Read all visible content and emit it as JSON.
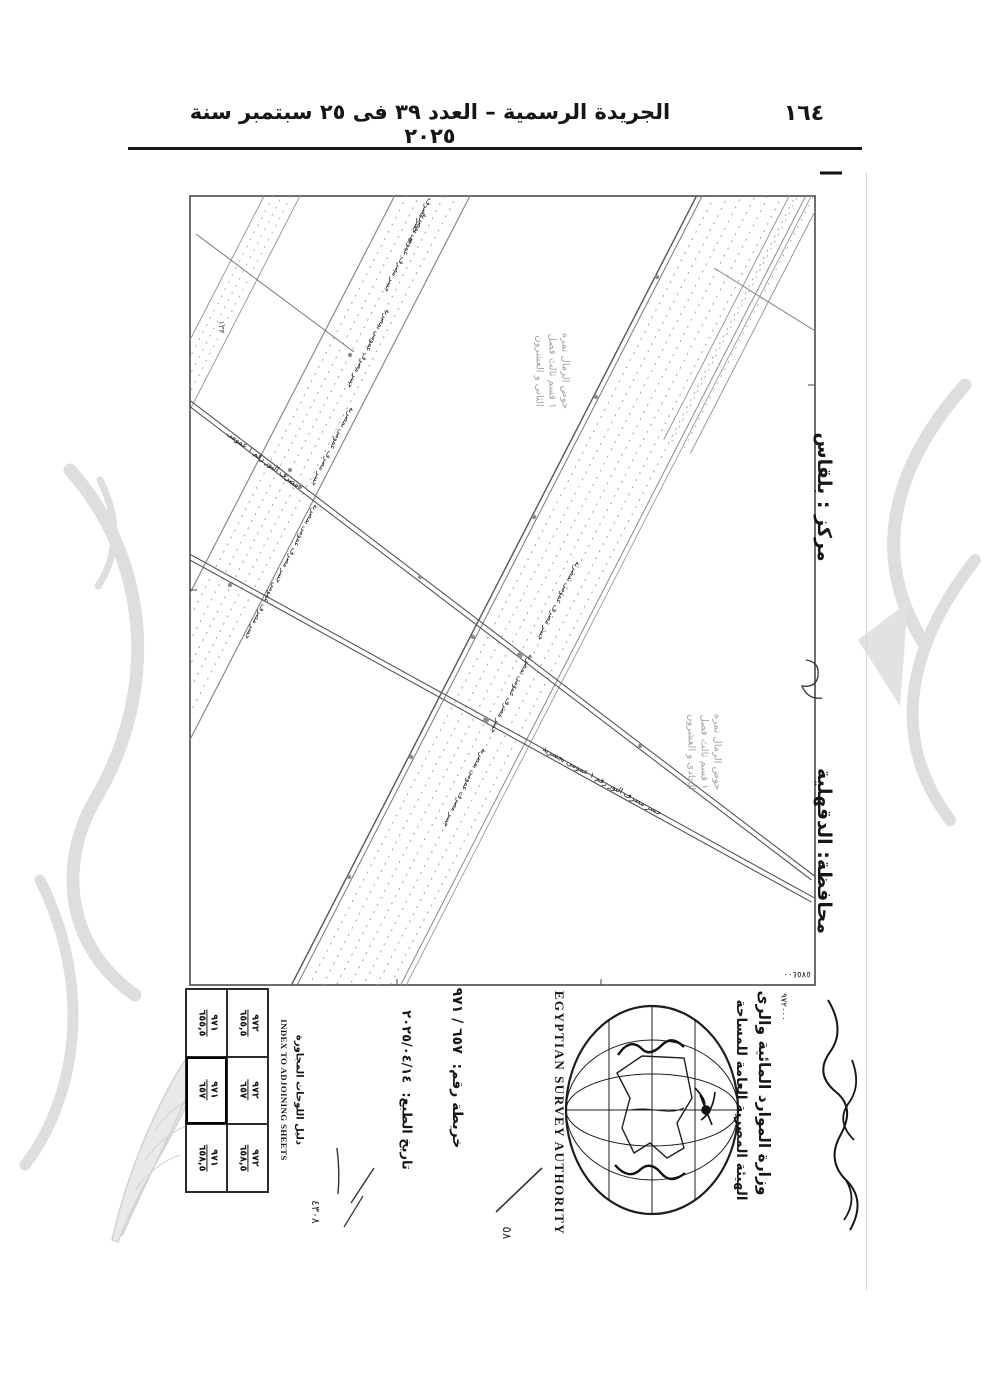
{
  "colors": {
    "ink": "#161616",
    "map_line": "#6e6e6e",
    "faded_label": "#a3a3a3",
    "watermark": "#dedede"
  },
  "header": {
    "page_number": "١٦٤",
    "gazette_title": "الجريدة الرسمية – العدد ٣٩ فى ٢٥ سبتمبر سنة ٢٠٢٥"
  },
  "map": {
    "markaz": "مركز : بلقاس",
    "governorate": "محافظة: الدقهلية",
    "corner_coordinate_vertical": "٩٧٢٠٠٠",
    "corner_coordinate_horizontal": "٥٧٥٤٠٠",
    "edge_number": "١٣٣",
    "hod_label_1": [
      "حوض الرمال نمره",
      "١ قسم ثالث فصل",
      "الثانى و العشرون"
    ],
    "hod_label_2": [
      "حوض الرمال نمره",
      "١ قسم ثالث فصل",
      "الحادى و العشرون"
    ],
    "canal_labels": [
      {
        "text": "جسر مصرف عمومى بمصرية"
      },
      {
        "text": "جسر مصرف عمومى بمصرية"
      },
      {
        "text": "جسر مصرف عمومى بمصرية"
      },
      {
        "text": "جسر مصرف عمومى بمصرية"
      },
      {
        "text": "جسر مصرف عمومى"
      },
      {
        "text": "جسر مصرف عمومى بمصرية"
      },
      {
        "text": "جسر مصرف عمومى بمصرية"
      },
      {
        "text": "جسر مصرف عمومى بمصرية"
      },
      {
        "text": "جسر مصرف"
      },
      {
        "text": "مصرف النور رقم ١ عمومى"
      },
      {
        "text": "جسر مصرف النور رقم ١ عمومى بجسرية"
      }
    ]
  },
  "title_block": {
    "ministry_ar": "وزارة الموارد المائية والرى",
    "authority_ar": "الهيئة المصرية العامة للمساحة",
    "authority_en": "EGYPTIAN SURVEY AUTHORITY",
    "map_number": {
      "label": "خريطة رقم:",
      "value": "٦٥٧ / ٩٧١"
    },
    "print_date": {
      "label": "تاريخ الطبع:",
      "value": "٢٠٢٥/٠٤/١٤"
    },
    "handwritten": {
      "mark_1": "٥٨",
      "mark_2": "٤٣٠٨"
    },
    "index": {
      "title_ar": "دليل اللوحات المجاورة",
      "title_en": "INDEX TO ADJOINING SHEETS",
      "current_sheet": "٩٧١ / ٦٥٧",
      "grid": [
        {
          "left": {
            "num": "٩٧١",
            "den": "٦٥٥,٥"
          },
          "right": {
            "num": "٩٧٢",
            "den": "٦٥٥,٥"
          }
        },
        {
          "left": {
            "num": "٩٧١",
            "den": "٦٥٧"
          },
          "right": {
            "num": "٩٧٢",
            "den": "٦٥٧"
          }
        },
        {
          "left": {
            "num": "٩٧١",
            "den": "٦٥٨,٥"
          },
          "right": {
            "num": "٩٧٢",
            "den": "٦٥٨,٥"
          }
        }
      ]
    }
  }
}
